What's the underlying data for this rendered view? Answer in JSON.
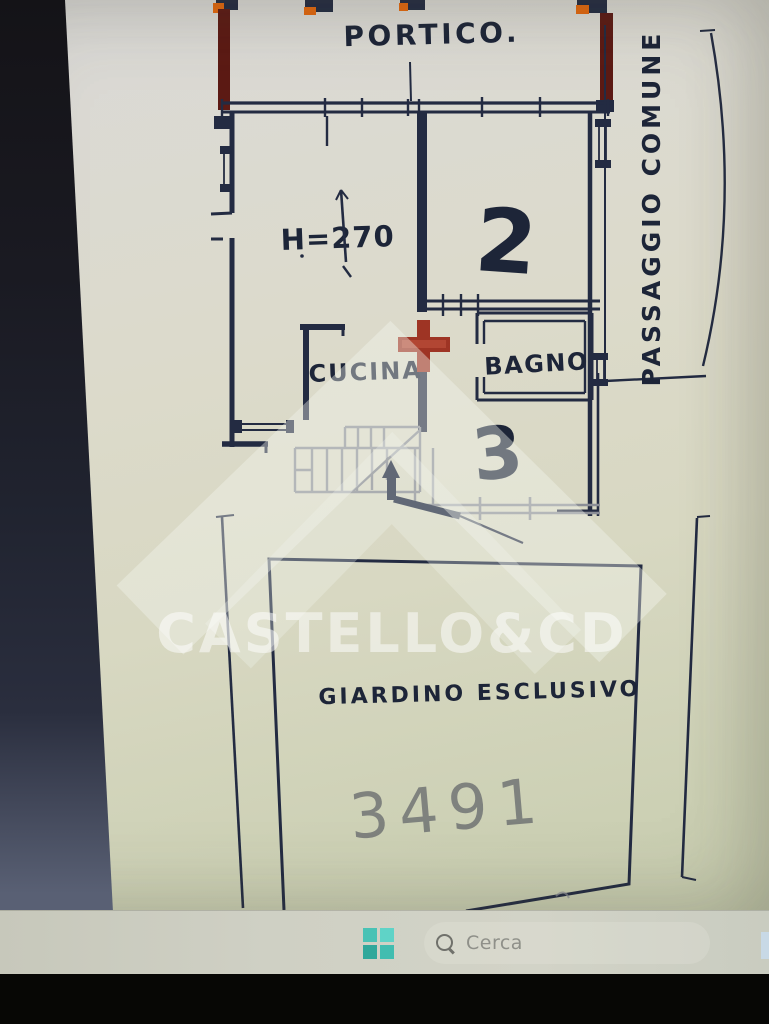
{
  "plan": {
    "labels": {
      "portico": "PORTICO.",
      "height": "H=270",
      "room2": "2",
      "cucina": "CUCINA",
      "bagno": "BAGNO",
      "room3": "3",
      "passaggio": "PASSAGGIO COMUNE",
      "giardino": "GIARDINO ESCLUSIVO",
      "garden_note": "3491"
    },
    "colors": {
      "ink": "#232b42",
      "pencil_gray": "#8b8e96",
      "marker_red": "#9e3424",
      "marker_maroon": "#5c1a14",
      "marker_orange": "#e4680e",
      "paper": "#dcdac8"
    }
  },
  "watermark": {
    "text": "CASTELLO&CD",
    "icon": "roof-watermark-icon"
  },
  "taskbar": {
    "search_placeholder": "Cerca",
    "colors": {
      "start_teal": "#3fbfb2",
      "bar": "#cfd0c4"
    }
  }
}
